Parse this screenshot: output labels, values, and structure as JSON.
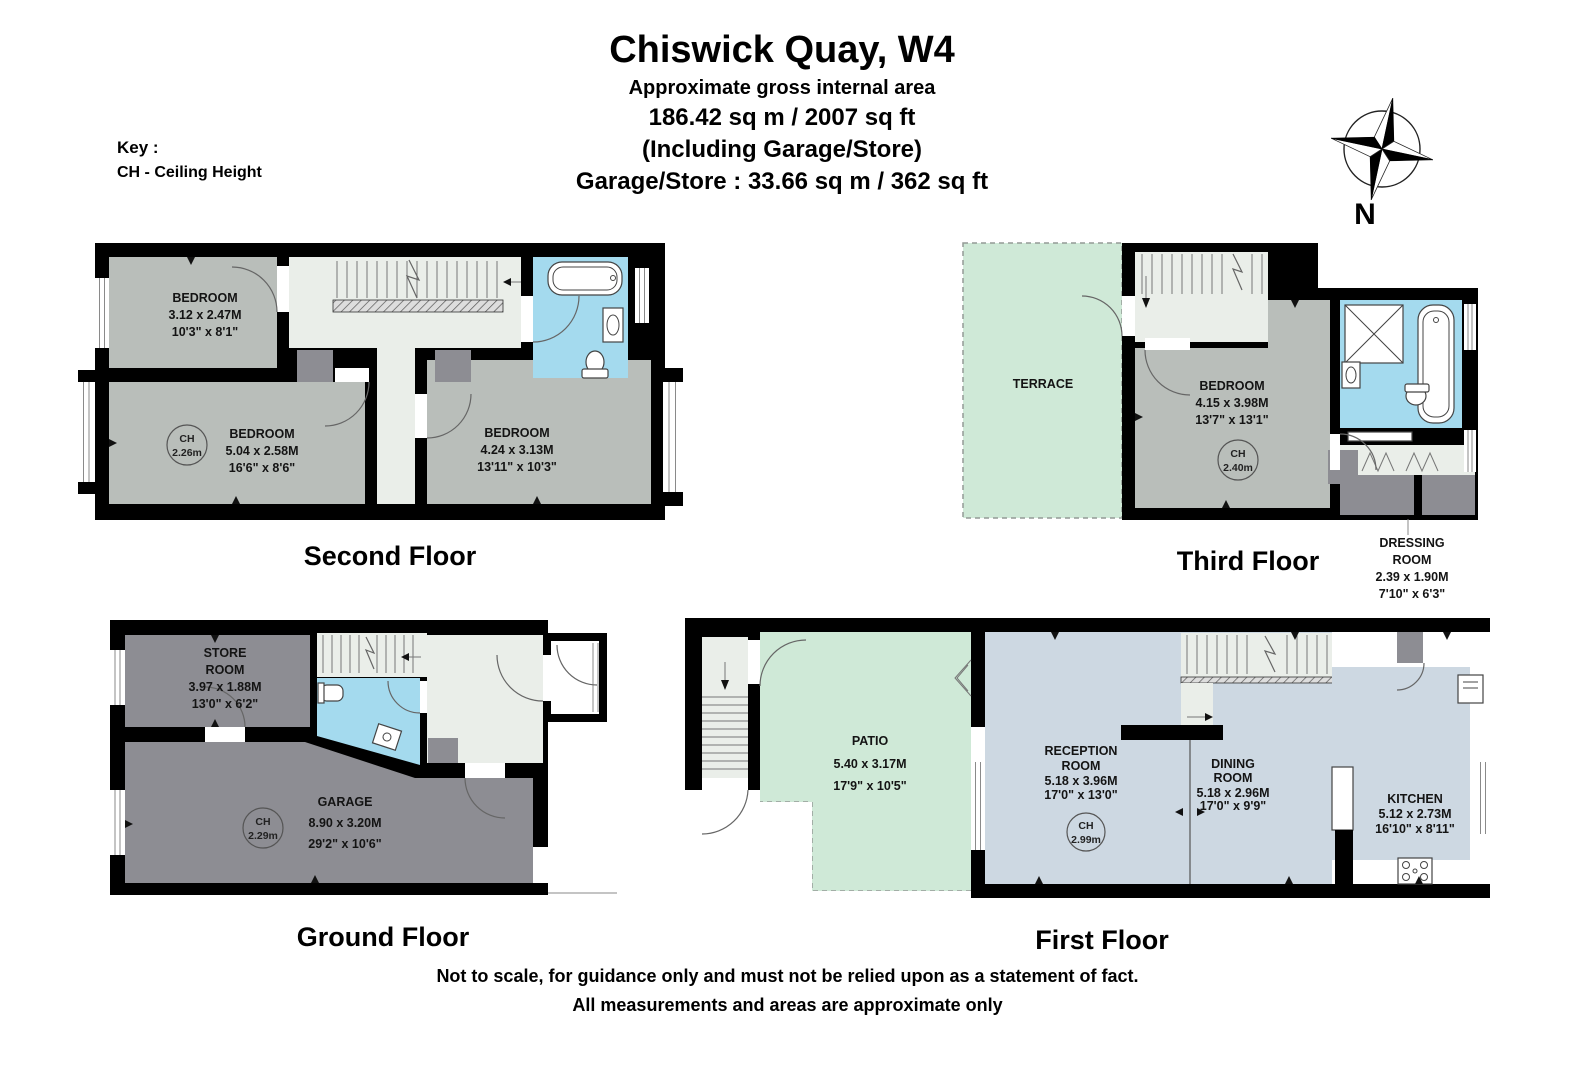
{
  "header": {
    "title": "Chiswick Quay, W4",
    "subtitle": "Approximate gross internal area",
    "area_line": "186.42 sq m /  2007 sq ft",
    "including_line": "(Including Garage/Store)",
    "garage_line": "Garage/Store : 33.66 sq m /  362 sq ft"
  },
  "key": {
    "label": "Key :",
    "entry": "CH - Ceiling Height"
  },
  "compass": {
    "label": "N"
  },
  "ch_abbr": "CH",
  "floors": {
    "second": {
      "title": "Second Floor",
      "rooms": {
        "bedroom_small": {
          "lines": [
            "BEDROOM",
            "3.12 x 2.47M",
            "10'3\" x 8'1\""
          ]
        },
        "bedroom_mid": {
          "lines": [
            "BEDROOM",
            "5.04 x 2.58M",
            "16'6\" x 8'6\""
          ],
          "ch": "2.26m"
        },
        "bedroom_right": {
          "lines": [
            "BEDROOM",
            "4.24 x 3.13M",
            "13'11\" x 10'3\""
          ]
        }
      }
    },
    "third": {
      "title": "Third Floor",
      "rooms": {
        "terrace": {
          "lines": [
            "TERRACE"
          ]
        },
        "bedroom": {
          "lines": [
            "BEDROOM",
            "4.15 x 3.98M",
            "13'7\" x 13'1\""
          ],
          "ch": "2.40m"
        },
        "dressing": {
          "lines": [
            "DRESSING",
            "ROOM",
            "2.39 x 1.90M",
            "7'10\" x 6'3\""
          ]
        }
      }
    },
    "ground": {
      "title": "Ground Floor",
      "rooms": {
        "store": {
          "lines": [
            "STORE",
            "ROOM",
            "3.97 x 1.88M",
            "13'0\" x 6'2\""
          ]
        },
        "garage": {
          "lines": [
            "GARAGE",
            "8.90 x 3.20M",
            "29'2\" x 10'6\""
          ],
          "ch": "2.29m"
        }
      }
    },
    "first": {
      "title": "First Floor",
      "rooms": {
        "patio": {
          "lines": [
            "PATIO",
            "5.40 x 3.17M",
            "17'9\" x 10'5\""
          ]
        },
        "reception": {
          "lines": [
            "RECEPTION",
            "ROOM",
            "5.18 x 3.96M",
            "17'0\" x 13'0\""
          ],
          "ch": "2.99m"
        },
        "dining": {
          "lines": [
            "DINING",
            "ROOM",
            "5.18 x 2.96M",
            "17'0\" x 9'9\""
          ]
        },
        "kitchen": {
          "lines": [
            "KITCHEN",
            "5.12 x 2.73M",
            "16'10\" x 8'11\""
          ]
        }
      }
    }
  },
  "footer": {
    "line1": "Not to scale, for guidance only and must not be relied upon as a statement of fact.",
    "line2": "All measurements and areas are approximate only"
  },
  "colors": {
    "wall": "#000000",
    "room_gray": "#b9beba",
    "room_dark": "#8d8d93",
    "room_blue": "#a4daee",
    "room_green": "#cfe9d7",
    "room_bluegray": "#cdd8e2",
    "floor_light": "#eaeee9"
  }
}
